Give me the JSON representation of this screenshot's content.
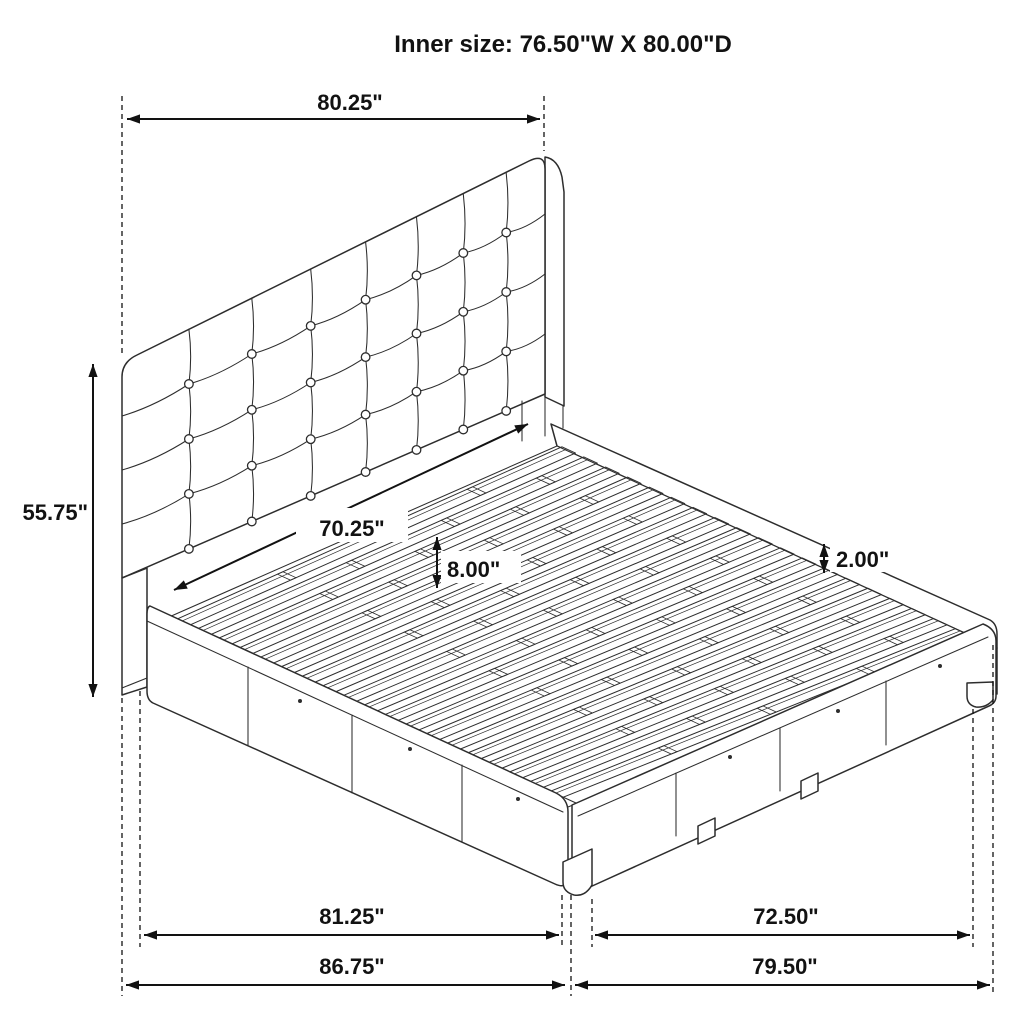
{
  "title": "Inner size: 76.50\"W X 80.00\"D",
  "dimensions": {
    "headboard_width": "80.25\"",
    "headboard_height": "55.75\"",
    "headboard_inner_width": "70.25\"",
    "slat_spacing": "8.00\"",
    "rail_lip_height": "2.00\"",
    "platform_side_length": "81.25\"",
    "overall_depth": "86.75\"",
    "footboard_inner_width": "72.50\"",
    "overall_width": "79.50\""
  },
  "colors": {
    "line": "#2d2d2d",
    "dimension": "#121212",
    "background": "#ffffff"
  }
}
